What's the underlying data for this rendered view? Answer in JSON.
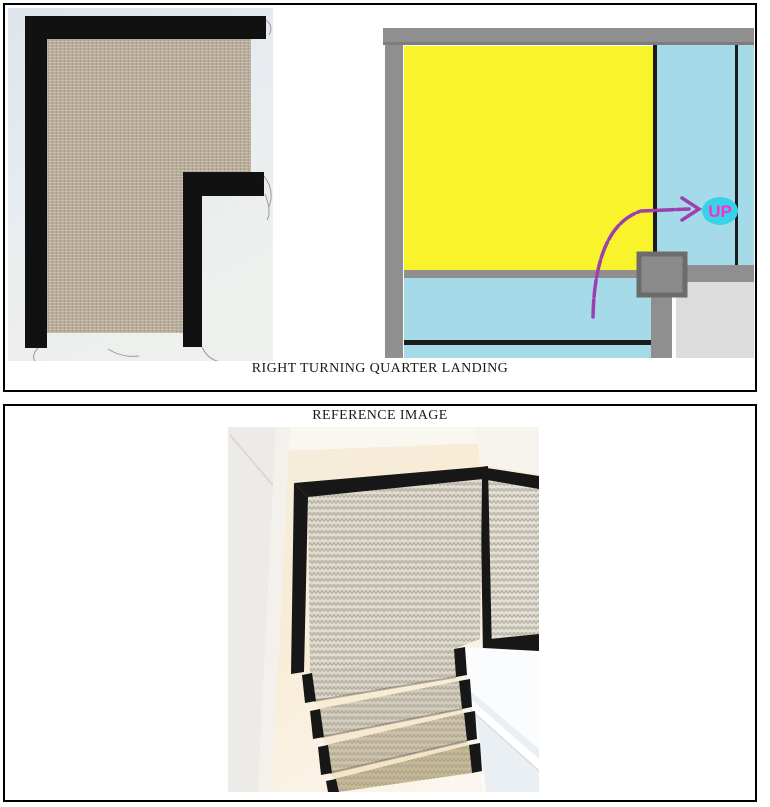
{
  "panel1": {
    "caption": "RIGHT TURNING QUARTER LANDING",
    "carpet_photo": {
      "carpet_color": "#b6a897",
      "binding_color": "#111111",
      "background_top": "#dde4ec",
      "background_bottom": "#eef0ed"
    },
    "floor_plan": {
      "up_label": "UP",
      "landing_color": "#f8f32a",
      "stair_color": "#a5dbe9",
      "wall_color": "#8f8f8f",
      "floor_color": "#dcdcdc",
      "line_color": "#1c1c1c",
      "arrow_color": "#9d3fae",
      "up_text_color": "#ff2cc9",
      "up_highlight_color": "#38d3e9",
      "post_color": "#8a8a8a",
      "post_border_color": "#6c6c6c"
    }
  },
  "panel2": {
    "title": "REFERENCE IMAGE",
    "photo": {
      "binding_color": "#171717",
      "carpet_base_color": "#e2ddd1"
    }
  }
}
